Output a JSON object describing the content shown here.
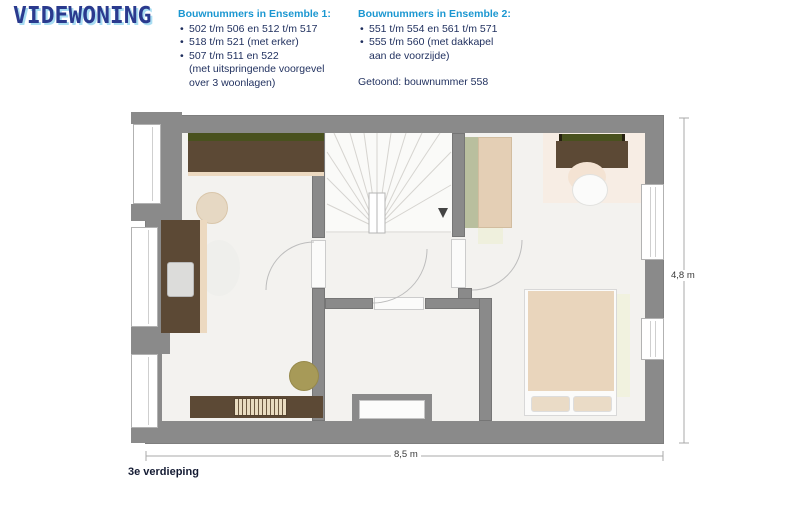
{
  "logo": {
    "text": "VIDEWONING"
  },
  "header": {
    "ensemble1": {
      "title": "Bouwnummers in Ensemble 1:",
      "items": [
        "502 t/m 506 en 512 t/m 517",
        "518 t/m 521 (met erker)",
        "507 t/m 511 en 522\n(met uitspringende voorgevel\nover 3 woonlagen)"
      ]
    },
    "ensemble2": {
      "title": "Bouwnummers in Ensemble 2:",
      "items": [
        "551 t/m 554 en 561 t/m 571",
        "555 t/m 560 (met dakkapel\naan de voorzijde)"
      ],
      "shown": "Getoond: bouwnummer 558"
    }
  },
  "plan": {
    "floor_label": "3e verdieping",
    "dimensions": {
      "width_label": "8,5 m",
      "height_label": "4,8 m"
    }
  },
  "colors": {
    "accent_blue": "#1b97d1",
    "navy": "#1f2f5e",
    "logo_blue": "#2a3a8e",
    "logo_glow": "#a9ddf2",
    "wall_gray": "#8a8a8a",
    "wood_brown": "#5c4935",
    "bed_tan": "#e9d5bc",
    "olive_green": "#49511e",
    "sage": "#b9bf9e"
  }
}
